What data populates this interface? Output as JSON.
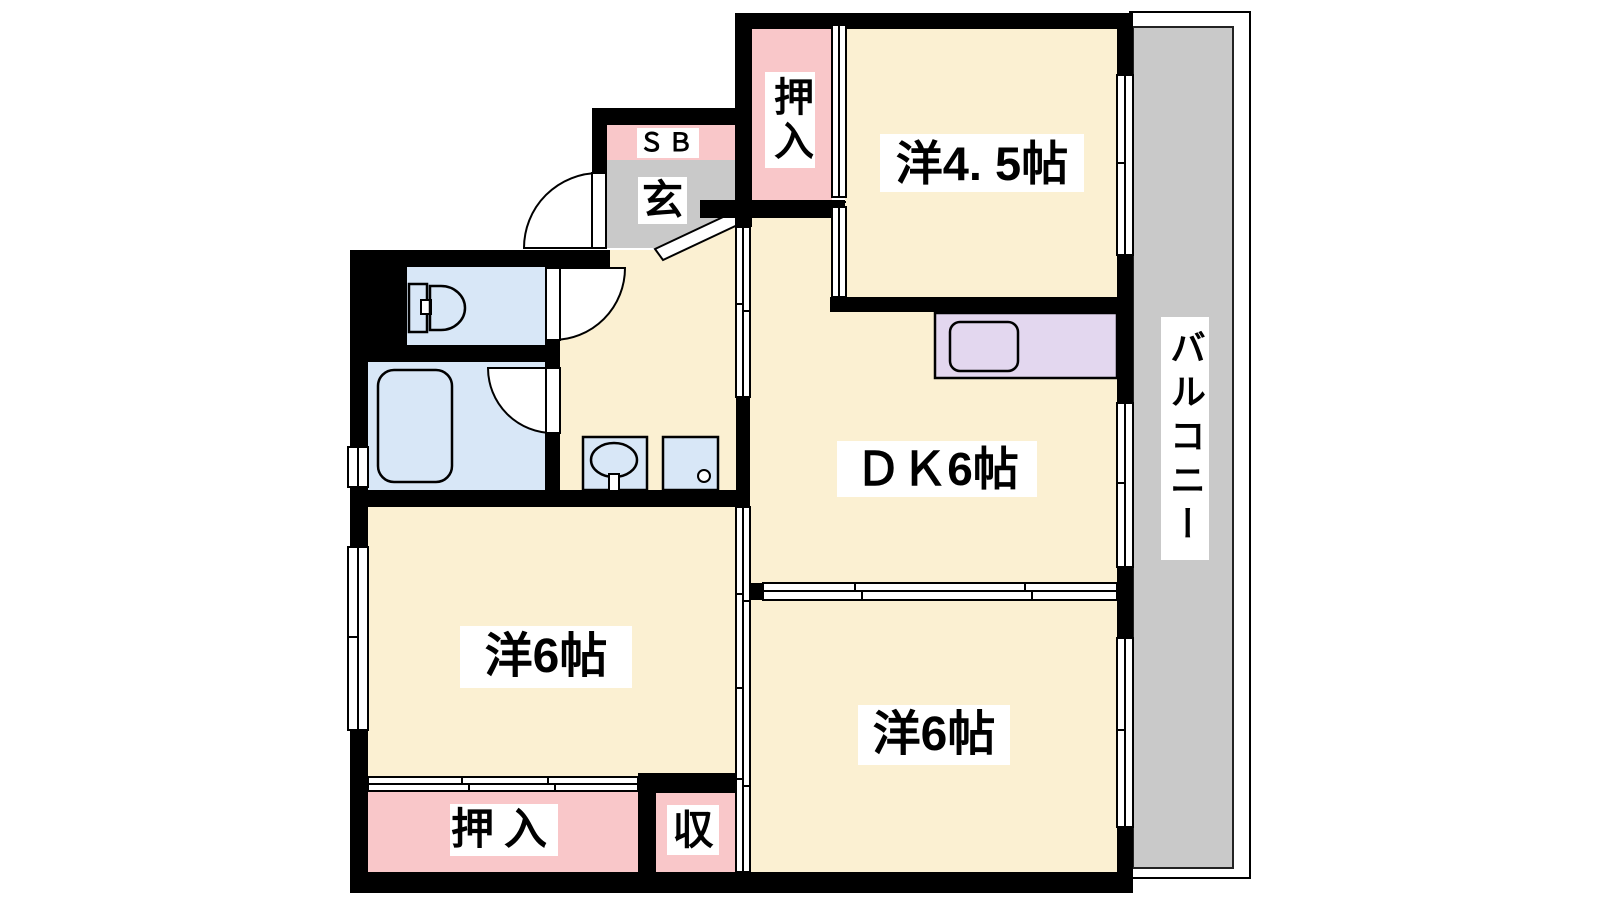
{
  "floor_plan": {
    "labels": {
      "closet_top": "押入",
      "western_room_4_5": "洋4. 5帖",
      "shoe_box": "ＳＢ",
      "entrance": "玄",
      "balcony": "バルコニー",
      "dining_kitchen": "ＤＫ6帖",
      "western_room_6_left": "洋6帖",
      "western_room_6_right": "洋6帖",
      "closet_bottom": "押入",
      "storage": "収"
    },
    "colors": {
      "background": "#FFFFFF",
      "wall": "#000000",
      "room_floor": "#FBF0D2",
      "closet": "#F9C7C9",
      "entrance_floor": "#C9C9C9",
      "balcony_floor": "#C9C9C9",
      "sanitary": "#D8E7F7",
      "kitchen_counter": "#E3D7EF"
    }
  }
}
